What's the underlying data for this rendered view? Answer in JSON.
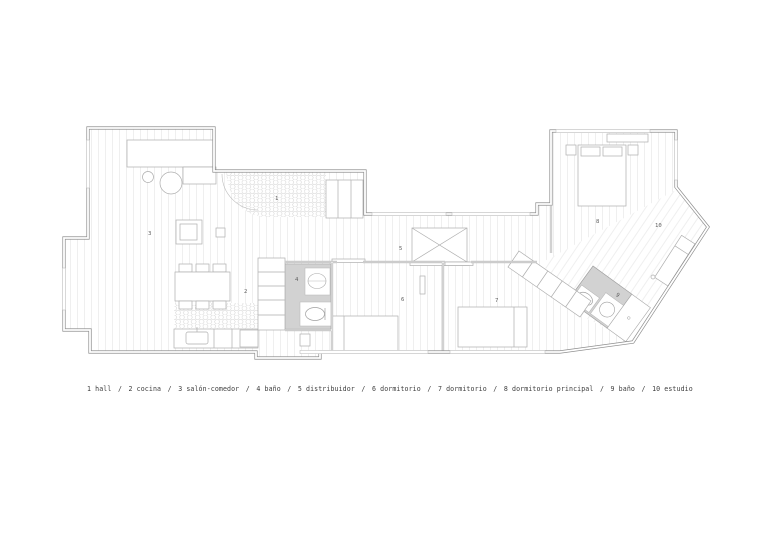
{
  "legend": {
    "separator": "/",
    "items": [
      {
        "number": "1",
        "label": "hall"
      },
      {
        "number": "2",
        "label": "cocina"
      },
      {
        "number": "3",
        "label": "salón-comedor"
      },
      {
        "number": "4",
        "label": "baño"
      },
      {
        "number": "5",
        "label": "distribuidor"
      },
      {
        "number": "6",
        "label": "dormitorio"
      },
      {
        "number": "7",
        "label": "dormitorio"
      },
      {
        "number": "8",
        "label": "dormitorio principal"
      },
      {
        "number": "9",
        "label": "baño"
      },
      {
        "number": "10",
        "label": "estudio"
      }
    ]
  },
  "colors": {
    "wall": "#8f8f8f",
    "partition": "#9a9a9a",
    "furniture_line": "#aeaeae",
    "floor_board_line": "#ebebeb",
    "hex_tile_line": "#d2d2d2",
    "bathroom_floor": "#d2d2d2",
    "label_text": "#5f5f5f",
    "background": "#ffffff"
  }
}
